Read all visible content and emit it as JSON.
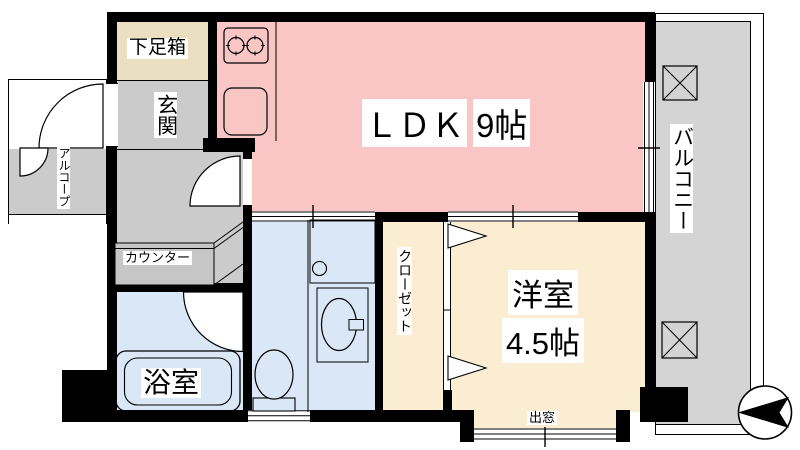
{
  "plan": {
    "type": "apartment-floor-plan",
    "rooms": {
      "shoe_box": {
        "label": "下足箱"
      },
      "entrance": {
        "label": "玄関"
      },
      "ldk": {
        "name": "ＬＤＫ",
        "size": "9帖"
      },
      "western_room": {
        "name": "洋室",
        "size": "4.5帖"
      },
      "closet": {
        "label": "クローゼット"
      },
      "bathroom": {
        "label": "浴室"
      },
      "balcony": {
        "label": "バルコニー"
      },
      "alcove": {
        "label": "アルコープ"
      },
      "counter": {
        "label": "カウンター"
      },
      "bay_window": {
        "label": "出窓"
      }
    },
    "fixtures": [
      "gas-stove-two-burner",
      "kitchen-sink",
      "bathtub",
      "toilet",
      "washbasin",
      "washing-machine-space",
      "balcony-equipment-box-top",
      "balcony-equipment-box-bottom",
      "entrance-double-door-swing",
      "hallway-door-swing",
      "bathroom-door-swing",
      "closet-folding-door-arrows",
      "sliding-window-ldk",
      "sliding-window-western-room",
      "compass-needle-pointing-left"
    ],
    "colors": {
      "wall": "#000000",
      "ldk_pink": "#f9c6c5",
      "room_cream": "#faedd2",
      "wet_area_blue": "#d9e7f7",
      "hall_gray": "#cbcbcb",
      "balcony_gray": "#d4d4d4",
      "shoe_box_beige": "#eadfc0"
    }
  }
}
